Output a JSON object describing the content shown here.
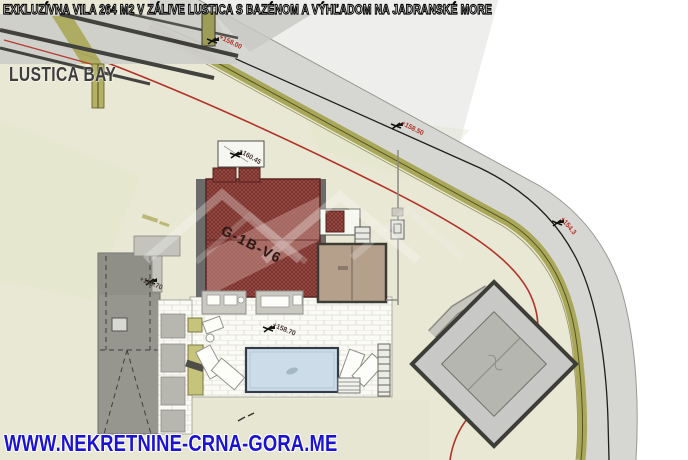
{
  "header": {
    "title": "EXKLUZÍVNA VILA 264 M2 V ZÁLIVE LUSTICA S BAZÉNOM A VÝHĽADOM NA JADRANSKÉ MORE"
  },
  "watermarks": {
    "development_name": "LUSTICA BAY",
    "website": "WWW.NEKRETNINE-CRNA-GORA.ME"
  },
  "plan": {
    "building_label": "G-1B-V6",
    "elevations": {
      "road_top": "+158.00",
      "road_mid": "+158.50",
      "road_right": "+154.3",
      "entrance": "+160.45",
      "west_terrace": "+159.70",
      "main_terrace": "+158.70"
    }
  },
  "colors": {
    "title_text": "#ffffff",
    "title_outline": "#000000",
    "website_blue": "#1b13cf",
    "watermark_gray": "#3e3d3d",
    "elevation_red": "#b03328",
    "elevation_dark": "#4a3a34",
    "setback_red": "#b23228",
    "plot_cream": "#e9e8d4",
    "road_gray": "#d6d6d2",
    "boundary_olive": "#a9a75a",
    "roof_red": "#9c4a44",
    "roof_red_dark": "#5a2420",
    "deck_tan": "#b5a08c",
    "pool_blue": "#ccdce9",
    "pool_border": "#333c47",
    "terrace_white": "#fbfbf6",
    "driveway_gray": "#96968f",
    "neighbor_gray": "#c8c8c6",
    "wall_gray": "#6b6b6b"
  }
}
